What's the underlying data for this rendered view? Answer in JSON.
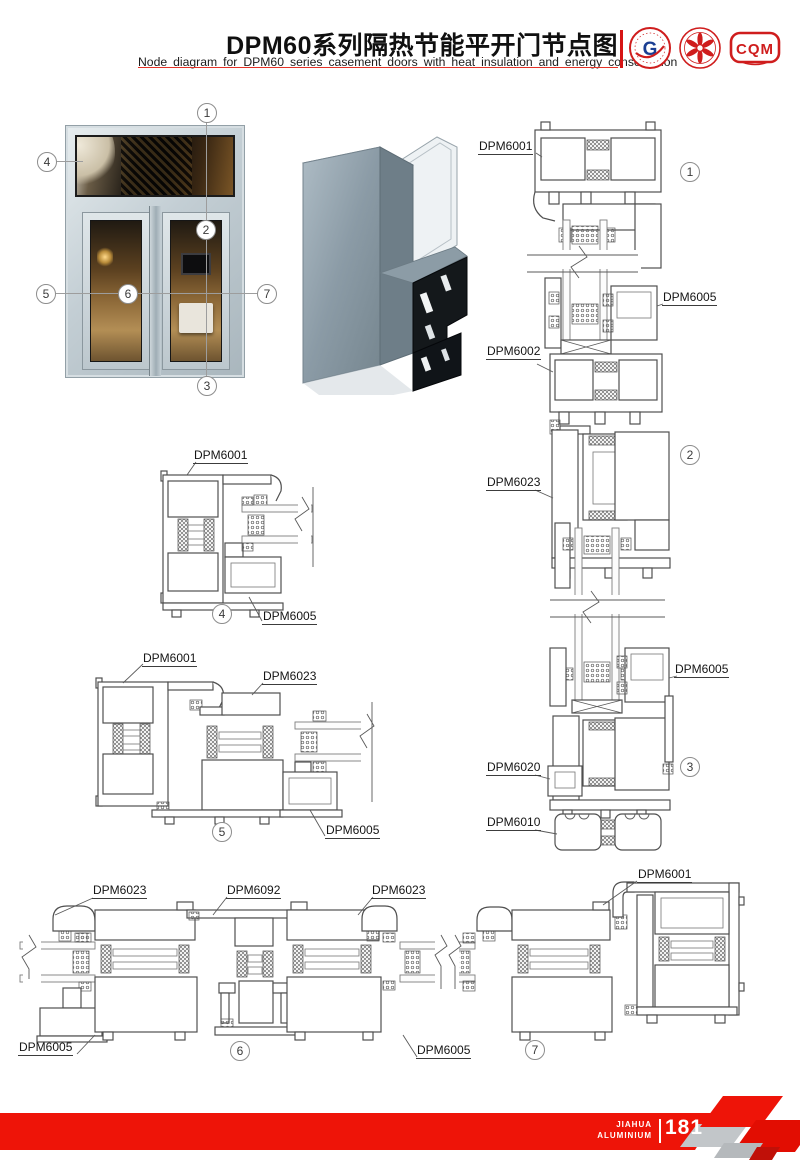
{
  "header": {
    "title": "DPM60系列隔热节能平开门节点图",
    "subtitle": "Node diagram for DPM60 series casement doors with heat insulation and energy conservation",
    "logos": {
      "logo1": "G",
      "logo3": "CQM"
    }
  },
  "callouts": {
    "c1": "1",
    "c2": "2",
    "c3": "3",
    "c4": "4",
    "c5": "5",
    "c6": "6",
    "c7": "7"
  },
  "vertical_section": {
    "labels": {
      "top_frame": "DPM6001",
      "sash_upper": "DPM6005",
      "transom_lower": "DPM6002",
      "transom": "DPM6023",
      "sash_lower": "DPM6005",
      "threshold": "DPM6020",
      "floor_profile": "DPM6010"
    }
  },
  "detail_4": {
    "labels": {
      "frame": "DPM6001",
      "sash": "DPM6005"
    }
  },
  "detail_5": {
    "labels": {
      "frame": "DPM6001",
      "mullion": "DPM6023",
      "sash": "DPM6005"
    }
  },
  "horizontal_section": {
    "labels": {
      "leaf_left": "DPM6023",
      "mullion_center": "DPM6092",
      "leaf_right": "DPM6023",
      "frame_right": "DPM6001",
      "sash_left": "DPM6005",
      "sash_right": "DPM6005"
    }
  },
  "footer": {
    "brand_line1": "JIAHUA",
    "brand_line2": "ALUMINIUM",
    "page_number": "181"
  },
  "colors": {
    "accent_red": "#ee1408",
    "logo_red": "#cf1d1d",
    "line_gray": "#4f4f4f"
  }
}
